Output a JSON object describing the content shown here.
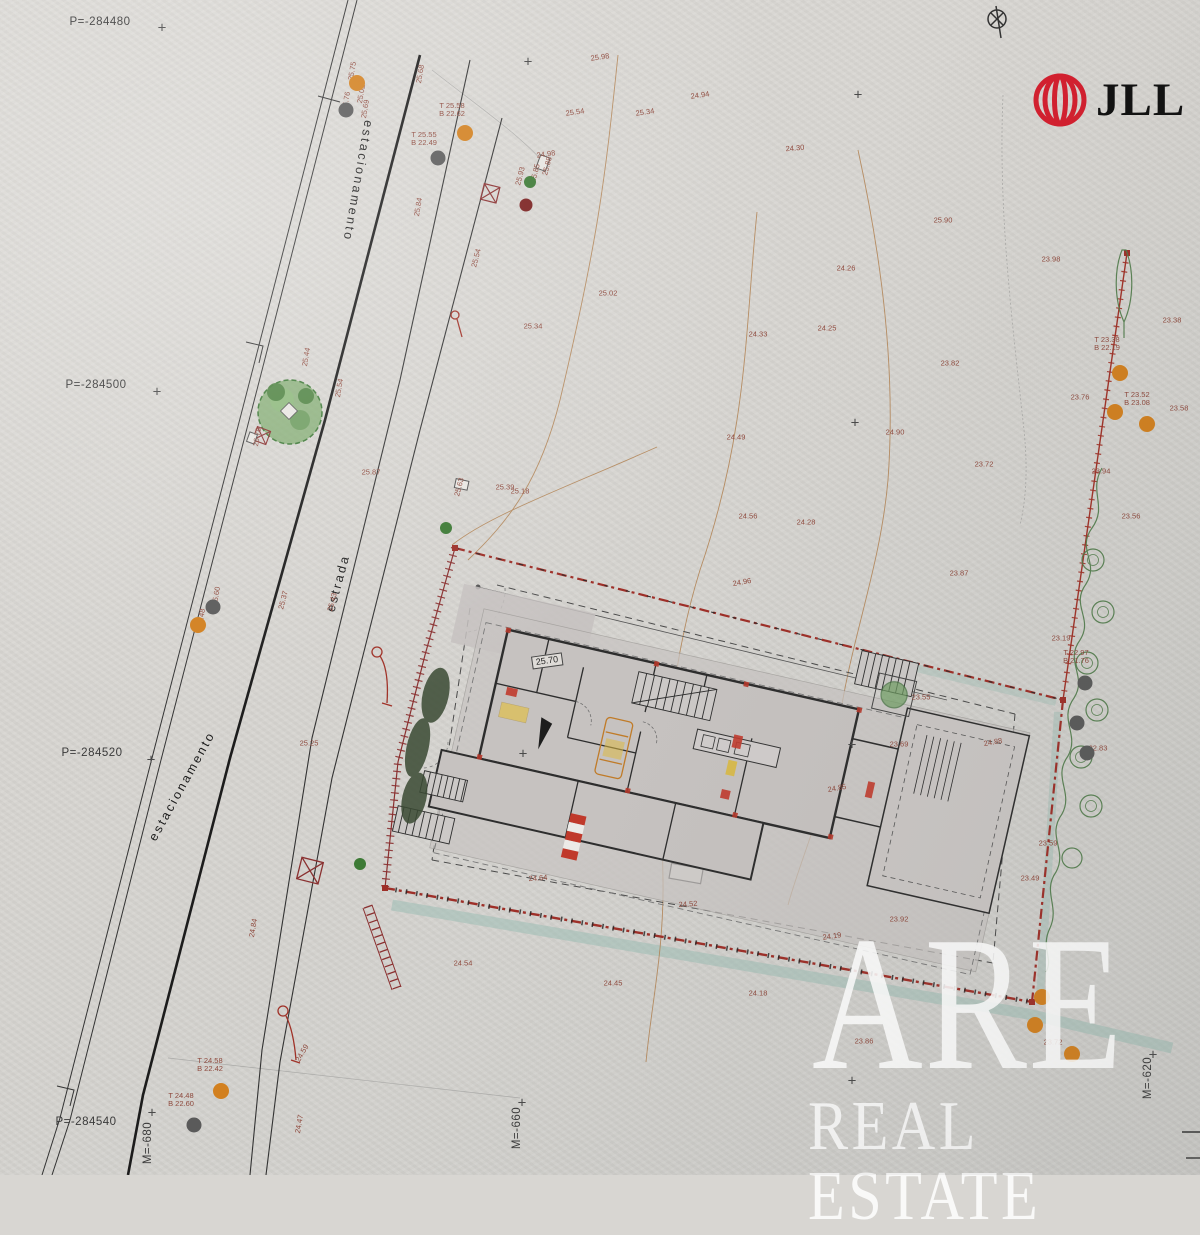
{
  "logo": {
    "brand": "JLL"
  },
  "watermark": {
    "line1": "ARE",
    "line2": "REAL ESTATE"
  },
  "plan_label": {
    "text": "25.70",
    "x": 547,
    "y": 661,
    "rot": -8
  },
  "colors": {
    "paper": "#d7d5d1",
    "boundary_red": "#9e2f28",
    "hatch_red": "#8a3030",
    "contour_tan": "#b08050",
    "teal_band": "#9dbdb4",
    "tree_green": "#4e7a48",
    "dot_orange": "#d2801f",
    "dot_gray": "#5a5a5a",
    "dot_green": "#3d7a35",
    "dot_darkred": "#7a1f1f",
    "label_red": "#8f4a3e",
    "logo_red": "#d31f2e"
  },
  "grid_labels": [
    {
      "t": "P=-284480",
      "x": 100,
      "y": 22,
      "r": 0
    },
    {
      "t": "P=-284500",
      "x": 96,
      "y": 385,
      "r": 0
    },
    {
      "t": "P=-284520",
      "x": 92,
      "y": 753,
      "r": 0
    },
    {
      "t": "P=-284540",
      "x": 86,
      "y": 1122,
      "r": 0
    },
    {
      "t": "M=-680",
      "x": 148,
      "y": 1143,
      "r": -90
    },
    {
      "t": "M=-660",
      "x": 517,
      "y": 1128,
      "r": -90
    },
    {
      "t": "M=-620",
      "x": 1148,
      "y": 1078,
      "r": -90
    }
  ],
  "grid_crosses": [
    [
      162,
      28
    ],
    [
      528,
      62
    ],
    [
      858,
      95
    ],
    [
      157,
      392
    ],
    [
      855,
      423
    ],
    [
      151,
      760
    ],
    [
      523,
      754
    ],
    [
      852,
      745
    ],
    [
      152,
      1113
    ],
    [
      522,
      1103
    ],
    [
      852,
      1081
    ],
    [
      1153,
      1055
    ]
  ],
  "road_labels": [
    {
      "t": "estacionamento",
      "x": 358,
      "y": 181,
      "r": 100
    },
    {
      "t": "estrada",
      "x": 338,
      "y": 583,
      "r": -75
    },
    {
      "t": "estacionamento",
      "x": 182,
      "y": 786,
      "r": -61
    }
  ],
  "spot_elevations": [
    {
      "t": "25.98",
      "x": 600,
      "y": 57,
      "r": -8
    },
    {
      "t": "25.34",
      "x": 645,
      "y": 112,
      "r": -8
    },
    {
      "t": "24.94",
      "x": 700,
      "y": 95,
      "r": -8
    },
    {
      "t": "24.30",
      "x": 795,
      "y": 148,
      "r": -5
    },
    {
      "t": "25.90",
      "x": 943,
      "y": 220,
      "r": 0
    },
    {
      "t": "24.26",
      "x": 846,
      "y": 268,
      "r": 0
    },
    {
      "t": "25.02",
      "x": 608,
      "y": 293,
      "r": 0
    },
    {
      "t": "24.33",
      "x": 758,
      "y": 334,
      "r": 0
    },
    {
      "t": "24.25",
      "x": 827,
      "y": 328,
      "r": 0
    },
    {
      "t": "23.82",
      "x": 950,
      "y": 363,
      "r": 0
    },
    {
      "t": "23.98",
      "x": 1051,
      "y": 259,
      "r": 0
    },
    {
      "t": "24.90",
      "x": 895,
      "y": 432,
      "r": 0
    },
    {
      "t": "24.49",
      "x": 736,
      "y": 437,
      "r": 0
    },
    {
      "t": "23.72",
      "x": 984,
      "y": 464,
      "r": 0
    },
    {
      "t": "24.56",
      "x": 748,
      "y": 516,
      "r": 0
    },
    {
      "t": "24.28",
      "x": 806,
      "y": 522,
      "r": 0
    },
    {
      "t": "23.87",
      "x": 959,
      "y": 573,
      "r": 0
    },
    {
      "t": "23.76",
      "x": 1080,
      "y": 397,
      "r": 0
    },
    {
      "t": "23.94",
      "x": 1101,
      "y": 471,
      "r": 0
    },
    {
      "t": "23.56",
      "x": 1131,
      "y": 516,
      "r": 0
    },
    {
      "t": "23.38",
      "x": 1172,
      "y": 320,
      "r": 0
    },
    {
      "t": "23.58",
      "x": 1179,
      "y": 408,
      "r": 0
    },
    {
      "t": "23.19",
      "x": 1061,
      "y": 638,
      "r": 0
    },
    {
      "t": "23.55",
      "x": 921,
      "y": 697,
      "r": 0
    },
    {
      "t": "23.69",
      "x": 899,
      "y": 744,
      "r": 0
    },
    {
      "t": "22.83",
      "x": 1098,
      "y": 748,
      "r": 0
    },
    {
      "t": "24.85",
      "x": 837,
      "y": 788,
      "r": -10
    },
    {
      "t": "24.88",
      "x": 993,
      "y": 742,
      "r": -10
    },
    {
      "t": "23.59",
      "x": 1048,
      "y": 843,
      "r": 0
    },
    {
      "t": "23.49",
      "x": 1030,
      "y": 878,
      "r": 0
    },
    {
      "t": "24.96",
      "x": 742,
      "y": 582,
      "r": -10
    },
    {
      "t": "25.39",
      "x": 505,
      "y": 487,
      "r": 0
    },
    {
      "t": "25.18",
      "x": 520,
      "y": 491,
      "r": 0
    },
    {
      "t": "25.63",
      "x": 459,
      "y": 487,
      "r": -75
    },
    {
      "t": "25.87",
      "x": 371,
      "y": 472,
      "r": 0
    },
    {
      "t": "26.78",
      "x": 257,
      "y": 437,
      "r": -80
    },
    {
      "t": "25.44",
      "x": 306,
      "y": 357,
      "r": -80
    },
    {
      "t": "25.54",
      "x": 339,
      "y": 388,
      "r": -80
    },
    {
      "t": "25.84",
      "x": 418,
      "y": 207,
      "r": -80
    },
    {
      "t": "25.34",
      "x": 533,
      "y": 326,
      "r": 0
    },
    {
      "t": "25.54",
      "x": 476,
      "y": 258,
      "r": -75
    },
    {
      "t": "25.54",
      "x": 575,
      "y": 112,
      "r": -8
    },
    {
      "t": "24.98",
      "x": 546,
      "y": 154,
      "r": -8
    },
    {
      "t": "25.85",
      "x": 535,
      "y": 173,
      "r": -75
    },
    {
      "t": "25.88",
      "x": 547,
      "y": 166,
      "r": -75
    },
    {
      "t": "25.93",
      "x": 520,
      "y": 176,
      "r": -75
    },
    {
      "t": "25.75",
      "x": 352,
      "y": 71,
      "r": -80
    },
    {
      "t": "25.02",
      "x": 361,
      "y": 94,
      "r": -80
    },
    {
      "t": "25.76",
      "x": 346,
      "y": 101,
      "r": -80
    },
    {
      "t": "25.69",
      "x": 365,
      "y": 109,
      "r": -80
    },
    {
      "t": "25.68",
      "x": 420,
      "y": 74,
      "r": -80
    },
    {
      "t": "25.60",
      "x": 216,
      "y": 596,
      "r": -80
    },
    {
      "t": "25.48",
      "x": 201,
      "y": 618,
      "r": -80
    },
    {
      "t": "25.43",
      "x": 332,
      "y": 602,
      "r": -75
    },
    {
      "t": "25.37",
      "x": 283,
      "y": 600,
      "r": -75
    },
    {
      "t": "25.25",
      "x": 309,
      "y": 743,
      "r": 0
    },
    {
      "t": "24.84",
      "x": 253,
      "y": 928,
      "r": -80
    },
    {
      "t": "24.47",
      "x": 299,
      "y": 1124,
      "r": -80
    },
    {
      "t": "24.59",
      "x": 302,
      "y": 1053,
      "r": -60
    },
    {
      "t": "24.64",
      "x": 538,
      "y": 878,
      "r": -4
    },
    {
      "t": "24.52",
      "x": 688,
      "y": 904,
      "r": -4
    },
    {
      "t": "24.54",
      "x": 463,
      "y": 963,
      "r": 0
    },
    {
      "t": "24.45",
      "x": 613,
      "y": 983,
      "r": 0
    },
    {
      "t": "24.18",
      "x": 758,
      "y": 993,
      "r": 0
    },
    {
      "t": "23.92",
      "x": 899,
      "y": 919,
      "r": 0
    },
    {
      "t": "24.19",
      "x": 832,
      "y": 936,
      "r": -8
    },
    {
      "t": "23.86",
      "x": 864,
      "y": 1041,
      "r": 0
    },
    {
      "t": "23.72",
      "x": 1053,
      "y": 1042,
      "r": 0
    }
  ],
  "tb_labels": [
    {
      "lines": [
        "T 25.58",
        "B 22.62"
      ],
      "x": 452,
      "y": 110
    },
    {
      "lines": [
        "T 25.55",
        "B 22.49"
      ],
      "x": 424,
      "y": 139
    },
    {
      "lines": [
        "T 23.38",
        "B 22.19"
      ],
      "x": 1107,
      "y": 344
    },
    {
      "lines": [
        "T 23.52",
        "B 23.08"
      ],
      "x": 1137,
      "y": 399
    },
    {
      "lines": [
        "T 22.97",
        "B 21.76"
      ],
      "x": 1076,
      "y": 657
    },
    {
      "lines": [
        "T 24.58",
        "B 22.42"
      ],
      "x": 210,
      "y": 1065
    },
    {
      "lines": [
        "T 24.48",
        "B 22.60"
      ],
      "x": 181,
      "y": 1100
    }
  ],
  "survey_points": {
    "orange": [
      [
        357,
        83
      ],
      [
        465,
        133
      ],
      [
        198,
        625
      ],
      [
        1120,
        373
      ],
      [
        1115,
        412
      ],
      [
        1147,
        424
      ],
      [
        221,
        1091
      ],
      [
        1042,
        997
      ],
      [
        1035,
        1025
      ],
      [
        1072,
        1054
      ]
    ],
    "gray": [
      [
        346,
        110
      ],
      [
        438,
        158
      ],
      [
        213,
        607
      ],
      [
        194,
        1125
      ],
      [
        1085,
        683
      ],
      [
        1077,
        723
      ],
      [
        1087,
        753
      ]
    ],
    "green": [
      [
        530,
        182
      ],
      [
        446,
        528
      ],
      [
        360,
        864
      ]
    ],
    "darkred": [
      [
        526,
        205
      ]
    ]
  }
}
